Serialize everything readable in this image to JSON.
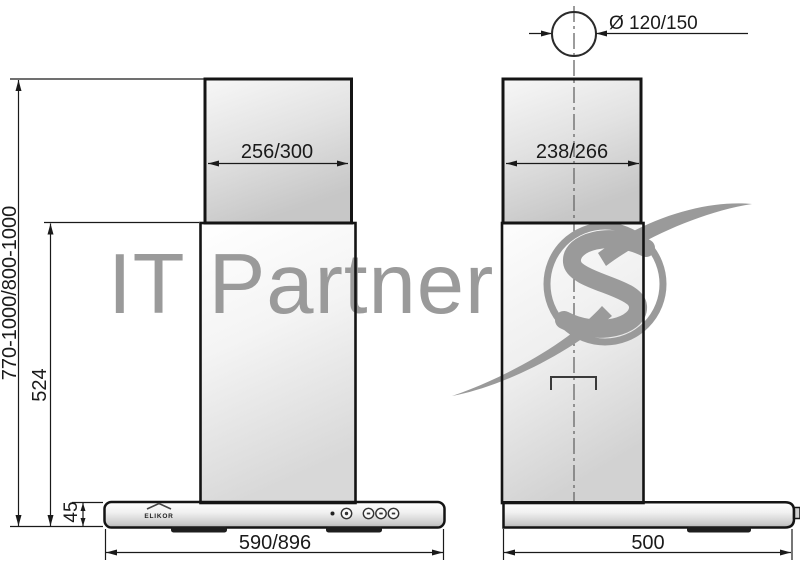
{
  "watermark": {
    "text": "IT Partner",
    "color": "#9a9a9a"
  },
  "brand": {
    "name": "ELIKOR"
  },
  "dimensions": {
    "front": {
      "total_height": "770-1000/800-1000",
      "duct_height": "524",
      "body_height": "45",
      "duct_width": "256/300",
      "body_width": "590/896"
    },
    "side": {
      "duct_depth": "238/266",
      "body_depth": "500",
      "outlet_diameter": "Ø 120/150"
    }
  },
  "colors": {
    "line": "#1a1a1a",
    "watermark": "#9a9a9a",
    "panel_dark_trim": "#1e1e1e"
  }
}
